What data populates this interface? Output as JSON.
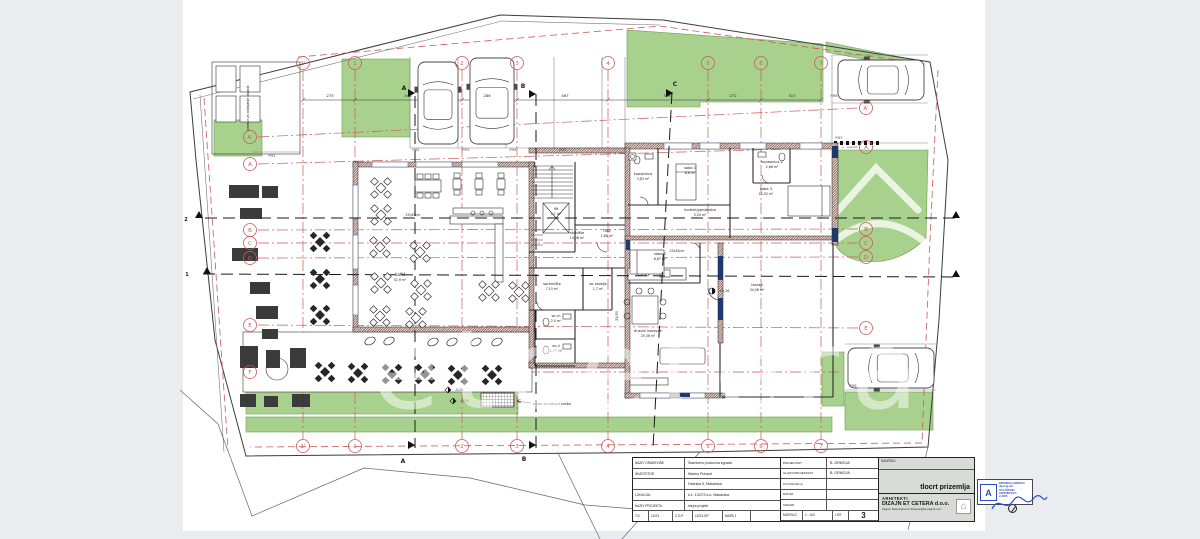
{
  "colors": {
    "bg": "#e9edf0",
    "paper": "#ffffff",
    "green": "#a9d18e",
    "red": "#cb5a5a",
    "navy": "#20386b",
    "blue": "#2b4bc8"
  },
  "titleblock": {
    "left": [
      {
        "label": "NAZIV GRAĐEVINE",
        "value": "Stambeno poslovna zgrada"
      },
      {
        "label": "INVESTITOR",
        "value": "Marino Puharić"
      },
      {
        "label": "",
        "value": "Hvarska 9, Makarska"
      },
      {
        "label": "LOKACIJA",
        "value": "k.č. 1347/3 k.o. Makarska"
      },
      {
        "label": "NAZIV PROJEKTA",
        "value": "idejni projekt"
      }
    ],
    "left_bottom": {
      "td_label": "T.D.",
      "td": "12/23",
      "zop_label": "Z.O.P.",
      "zop": "12/23-GP",
      "mapa": "MAPA 1"
    },
    "mid": [
      {
        "label": "PROJEKTANT",
        "value": "B. GRMOJA"
      },
      {
        "label": "GLAVNI PROJEKTANT",
        "value": "B. GRMOJA"
      },
      {
        "label": "±0,0=96,00mnv",
        "value": ""
      },
      {
        "label": "DATUM",
        "value": ""
      },
      {
        "label": "SJEVER",
        "value": ""
      }
    ],
    "mid_bottom": {
      "mjerilo_label": "MJERILO",
      "mjerilo": "1 : 100",
      "list_label": "LIST",
      "list": "3"
    },
    "stamp": {
      "initial": "A",
      "name": "BRANKICA GRMOJA",
      "title": "dipl.ing.arh.",
      "role": "OVLAŠTENA ARHITEKTICA",
      "number": "A 3978"
    },
    "right": {
      "header": "SADRŽAJ",
      "content": "tlocrt prizemlja",
      "firm_pre": "ARHITEKTI",
      "firm": "DIZAJN ET CETERA d.o.o.",
      "address": "Zagreb, Bukovinjeva 9/ dizajnetc@bk-zagreb.com",
      "logo_icon": "⌂"
    }
  },
  "plan": {
    "watermark": "etcetera",
    "grid_cols": [
      {
        "l": "1'",
        "x": 303
      },
      {
        "l": "1",
        "x": 355
      },
      {
        "l": "2",
        "x": 462
      },
      {
        "l": "3",
        "x": 517
      },
      {
        "l": "4",
        "x": 608
      },
      {
        "l": "5",
        "x": 708
      },
      {
        "l": "6",
        "x": 761
      },
      {
        "l": "7",
        "x": 821
      }
    ],
    "grid_rows": [
      {
        "l": "A'",
        "yl": 137,
        "yr": 108
      },
      {
        "l": "A",
        "yl": 164,
        "yr": 147
      },
      {
        "l": "B",
        "yl": 230,
        "yr": 229
      },
      {
        "l": "C",
        "yl": 243,
        "yr": 243
      },
      {
        "l": "D",
        "yl": 258,
        "yr": 257
      },
      {
        "l": "E",
        "yl": 325,
        "yr": 328
      },
      {
        "l": "F",
        "yl": 372,
        "yr": null
      }
    ],
    "labels": [
      {
        "t": "kafić",
        "x": 400,
        "y": 276,
        "s": 4.5
      },
      {
        "t": "52,9 m²",
        "x": 400,
        "y": 281,
        "s": 3.2
      },
      {
        "t": "stubište",
        "x": 577,
        "y": 234
      },
      {
        "t": "14,08 m²",
        "x": 577,
        "y": 239,
        "s": 3.2
      },
      {
        "t": "lift",
        "x": 556,
        "y": 210
      },
      {
        "t": "2,1 m²",
        "x": 556,
        "y": 215,
        "s": 3.2
      },
      {
        "t": "kupaonica",
        "x": 643,
        "y": 175
      },
      {
        "t": "3,83 m²",
        "x": 643,
        "y": 180,
        "s": 3.2
      },
      {
        "t": "soba 1",
        "x": 690,
        "y": 169
      },
      {
        "t": "8,6 m²",
        "x": 690,
        "y": 174,
        "s": 3.2
      },
      {
        "t": "kupaonica 2",
        "x": 772,
        "y": 163
      },
      {
        "t": "2,86 m²",
        "x": 772,
        "y": 168,
        "s": 3.2
      },
      {
        "t": "soba 3",
        "x": 766,
        "y": 190
      },
      {
        "t": "12,92 m²",
        "x": 766,
        "y": 195,
        "s": 3.2
      },
      {
        "t": "hodnik/garderoba",
        "x": 700,
        "y": 211
      },
      {
        "t": "5,04 m²",
        "x": 700,
        "y": 216,
        "s": 3.2
      },
      {
        "t": "ulaz",
        "x": 607,
        "y": 232
      },
      {
        "t": "1,68 m²",
        "x": 607,
        "y": 237,
        "s": 3.2
      },
      {
        "t": "soba 2",
        "x": 660,
        "y": 255
      },
      {
        "t": "8,67 m²",
        "x": 660,
        "y": 260,
        "s": 3.2
      },
      {
        "t": "spremište",
        "x": 552,
        "y": 285
      },
      {
        "t": "7,15 m²",
        "x": 552,
        "y": 290,
        "s": 3.2
      },
      {
        "t": "wc osoblje",
        "x": 598,
        "y": 285,
        "s": 3.3
      },
      {
        "t": "1,7 m²",
        "x": 598,
        "y": 290,
        "s": 3.2
      },
      {
        "t": "wc-m",
        "x": 556,
        "y": 317,
        "s": 3.3
      },
      {
        "t": "2,5 m²",
        "x": 556,
        "y": 322,
        "s": 3.2
      },
      {
        "t": "wc-ž",
        "x": 556,
        "y": 347,
        "s": 3.3
      },
      {
        "t": "2,77 m²",
        "x": 556,
        "y": 352,
        "s": 3.2
      },
      {
        "t": "dnevni boravak",
        "x": 648,
        "y": 332
      },
      {
        "t": "25,36 m²",
        "x": 648,
        "y": 337,
        "s": 3.2
      },
      {
        "t": "terasa",
        "x": 757,
        "y": 286
      },
      {
        "t": "34,08 m²",
        "x": 757,
        "y": 291,
        "s": 3.2
      },
      {
        "t": "25/43cm",
        "x": 677,
        "y": 252,
        "s": 3.4
      },
      {
        "t": "25/43cm",
        "x": 413,
        "y": 216,
        "s": 3.4
      },
      {
        "t": "25/90",
        "x": 618,
        "y": 316,
        "s": 3.4,
        "r": -90
      },
      {
        "t": "otvor za odvod zraka",
        "x": 533,
        "y": 405,
        "s": 3.6,
        "a": "start"
      },
      {
        "t": "prostor za odlaganje otpada",
        "x": 249,
        "y": 108,
        "s": 3.2,
        "r": -90
      },
      {
        "t": "PM1",
        "x": 272,
        "y": 157,
        "s": 3.4,
        "c": "#555"
      },
      {
        "t": "PM2",
        "x": 416,
        "y": 151,
        "s": 3.4,
        "c": "#555"
      },
      {
        "t": "PM3",
        "x": 466,
        "y": 151,
        "s": 3.4,
        "c": "#555"
      },
      {
        "t": "PM4",
        "x": 513,
        "y": 151,
        "s": 3.4,
        "c": "#555"
      },
      {
        "t": "PM5",
        "x": 563,
        "y": 151,
        "s": 3.4,
        "c": "#555"
      },
      {
        "t": "PM6",
        "x": 834,
        "y": 97,
        "s": 3.4,
        "c": "#555"
      },
      {
        "t": "PM7",
        "x": 839,
        "y": 139,
        "s": 3.4,
        "c": "#555"
      },
      {
        "t": "PM8",
        "x": 853,
        "y": 387,
        "s": 3.4,
        "c": "#555"
      },
      {
        "t": "275",
        "x": 330,
        "y": 97,
        "s": 3.8
      },
      {
        "t": "546",
        "x": 408,
        "y": 97,
        "s": 3.8
      },
      {
        "t": "286",
        "x": 487,
        "y": 97,
        "s": 3.8
      },
      {
        "t": "467",
        "x": 565,
        "y": 97,
        "s": 3.8
      },
      {
        "t": "319",
        "x": 667,
        "y": 97,
        "s": 3.8
      },
      {
        "t": "272",
        "x": 733,
        "y": 97,
        "s": 3.8
      },
      {
        "t": "317",
        "x": 792,
        "y": 97,
        "s": 3.8
      },
      {
        "t": "-0,01",
        "x": 455,
        "y": 391,
        "s": 3.4,
        "a": "start"
      },
      {
        "t": "-0,05",
        "x": 460,
        "y": 402,
        "s": 3.4,
        "a": "start"
      },
      {
        "t": "+3,26",
        "x": 719,
        "y": 292,
        "s": 3.4,
        "a": "start"
      },
      {
        "t": "A",
        "x": 404,
        "y": 90,
        "s": 6,
        "b": 1
      },
      {
        "t": "B",
        "x": 523,
        "y": 88,
        "s": 6,
        "b": 1
      },
      {
        "t": "C",
        "x": 675,
        "y": 86,
        "s": 6,
        "b": 1
      },
      {
        "t": "A",
        "x": 403,
        "y": 463,
        "s": 6,
        "b": 1
      },
      {
        "t": "B",
        "x": 524,
        "y": 461,
        "s": 6,
        "b": 1
      },
      {
        "t": "C",
        "x": 657,
        "y": 465,
        "s": 6,
        "b": 1
      },
      {
        "t": "2",
        "x": 186,
        "y": 221,
        "s": 5,
        "b": 1
      },
      {
        "t": "1",
        "x": 187,
        "y": 276,
        "s": 5,
        "b": 1
      }
    ],
    "tables_outdoor": [
      [
        320,
        242
      ],
      [
        320,
        279
      ],
      [
        320,
        315
      ],
      [
        325,
        372
      ],
      [
        358,
        373
      ],
      [
        392,
        374
      ],
      [
        425,
        374
      ],
      [
        458,
        375
      ],
      [
        492,
        375
      ]
    ],
    "tables_indoor": [
      [
        381,
        188
      ],
      [
        381,
        215
      ],
      [
        380,
        247
      ],
      [
        381,
        283
      ],
      [
        380,
        316
      ],
      [
        420,
        252
      ],
      [
        421,
        290
      ],
      [
        416,
        318
      ],
      [
        489,
        291
      ],
      [
        519,
        292
      ]
    ],
    "small_tables": [
      [
        457,
        184
      ],
      [
        479,
        184
      ],
      [
        501,
        184
      ]
    ],
    "umbrellas": [
      [
        370,
        341
      ],
      [
        389,
        341
      ],
      [
        433,
        342
      ],
      [
        452,
        342
      ],
      [
        476,
        342
      ],
      [
        497,
        342
      ]
    ],
    "benches": [
      [
        229,
        185,
        30,
        13
      ],
      [
        262,
        186,
        16,
        12
      ],
      [
        240,
        208,
        22,
        11
      ],
      [
        232,
        248,
        26,
        13
      ],
      [
        250,
        282,
        20,
        12
      ],
      [
        256,
        306,
        22,
        13
      ],
      [
        262,
        329,
        16,
        10
      ],
      [
        240,
        346,
        18,
        22
      ],
      [
        266,
        350,
        14,
        18
      ],
      [
        290,
        348,
        16,
        20
      ],
      [
        240,
        394,
        16,
        13
      ],
      [
        264,
        396,
        14,
        11
      ],
      [
        292,
        394,
        18,
        13
      ]
    ],
    "cars": [
      {
        "x": 418,
        "y": 62,
        "w": 40,
        "h": 82
      },
      {
        "x": 470,
        "y": 58,
        "w": 44,
        "h": 86
      },
      {
        "x": 838,
        "y": 60,
        "w": 86,
        "h": 40
      },
      {
        "x": 848,
        "y": 348,
        "w": 86,
        "h": 40
      }
    ]
  }
}
